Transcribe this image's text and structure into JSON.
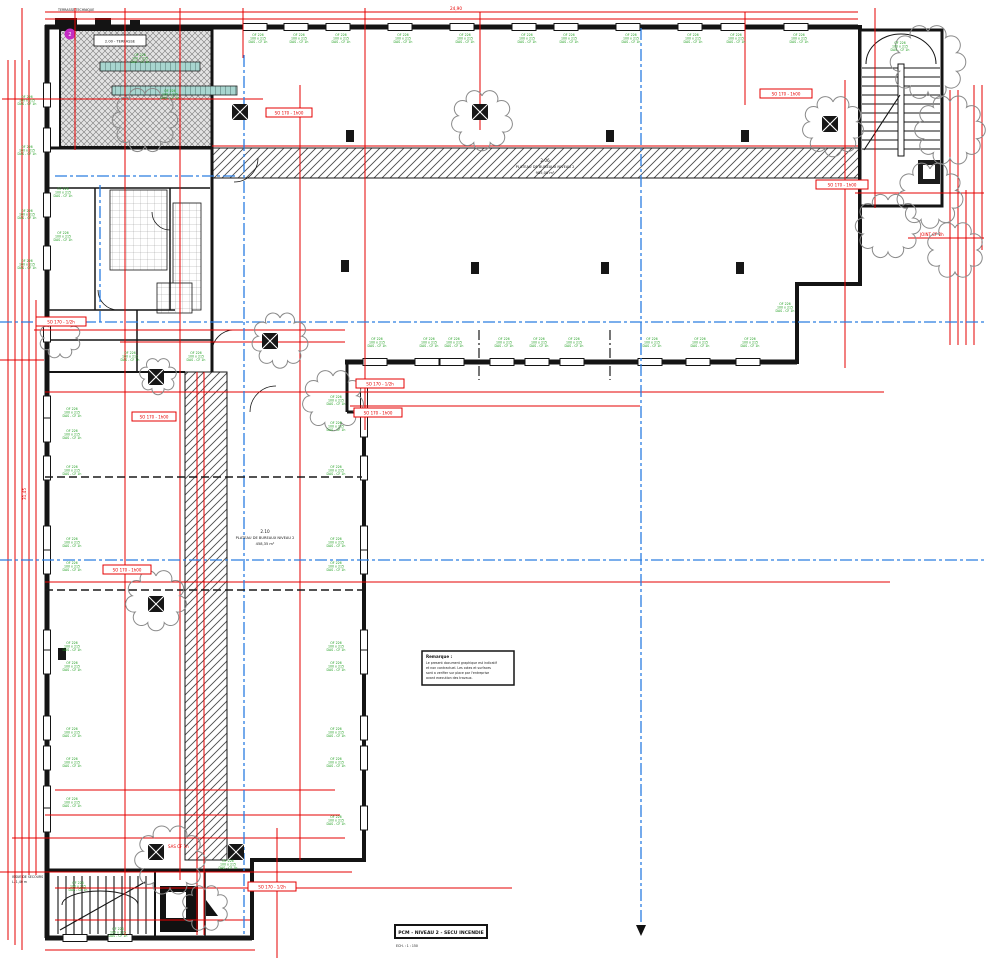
{
  "plan": {
    "title": "PCM - NIVEAU 2 - SECU INCENDIE",
    "scale_label": "ECH. : 1 : 150",
    "rooms": {
      "r206": {
        "number": "2.06",
        "name": "PLATEAU DE BUREAUX NIVEAU 2",
        "area": "985,00 m²"
      },
      "r210": {
        "number": "2.10",
        "name": "PLATEAU DE BUREAUX NIVEAU 2",
        "area": "458,35 m²"
      },
      "terrace": {
        "label": "2.00 - TERRASSE"
      }
    },
    "note": {
      "title": "Remarque :",
      "lines": [
        "Le present document graphique est indicatif",
        "et non contractuel. Les cotes et surfaces",
        "sont a verifier sur place par l'entreprise",
        "avant execution des travaux."
      ]
    },
    "labels": {
      "window": [
        "OF 226",
        "100 x 215",
        "DAS - CF 1h"
      ],
      "fire": "SO 170 - 1h00",
      "fire_half": "SO 170 - 1/2h",
      "sas": "SAS CF 1h",
      "joint": "JOINT CF 2h",
      "exit1": "ISSUE DE SECOURS",
      "exit2": "L. 1,40 m",
      "terrace_top": "TERRASSE TECHNIQUE",
      "detail_marker": "2"
    },
    "dims": {
      "top": "24,90",
      "left": "31,45"
    },
    "colors": {
      "dimension": "#e60000",
      "axis": "#2a7de1",
      "annotation": "#1e9e1e",
      "cloud": "#8a8a8a",
      "marker": "#c32cc3"
    }
  }
}
